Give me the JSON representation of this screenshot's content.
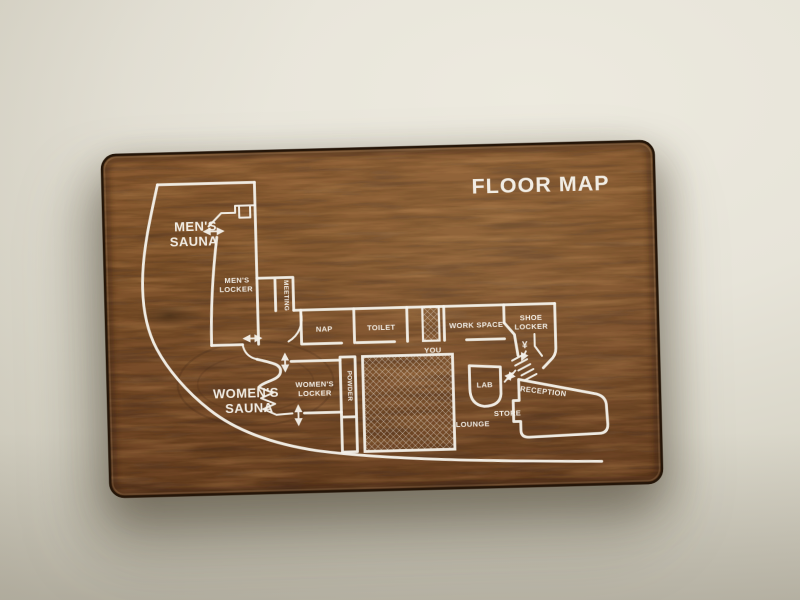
{
  "sign": {
    "title": "FLOOR MAP",
    "labels": {
      "mens_sauna_1": "MEN'S",
      "mens_sauna_2": "SAUNA",
      "mens_locker_1": "MEN'S",
      "mens_locker_2": "LOCKER",
      "meeting": "MEETING",
      "nap": "NAP",
      "toilet": "TOILET",
      "you": "YOU",
      "work_space": "WORK SPACE",
      "shoe_locker_1": "SHOE",
      "shoe_locker_2": "LOCKER",
      "yen_symbol": "¥",
      "womens_sauna_1": "WOMEN'S",
      "womens_sauna_2": "SAUNA",
      "womens_locker_1": "WOMEN'S",
      "womens_locker_2": "LOCKER",
      "powder": "POWDER",
      "lab": "LAB",
      "lounge": "LOUNGE",
      "store": "STORE",
      "reception": "RECEPTION"
    },
    "icons": {
      "door_arrow": "double-arrow-doorway",
      "stairs": "stairs-with-up-down-arrows",
      "sauna_stove": "sauna-stove",
      "you_marker": "hatched-location-box",
      "mesh_area": "hatched-floor-area"
    },
    "colors": {
      "wood": "#7d5128",
      "wood_dark": "#3c2512",
      "line": "#f6f3ec",
      "wall": "#e7e4d9"
    }
  }
}
